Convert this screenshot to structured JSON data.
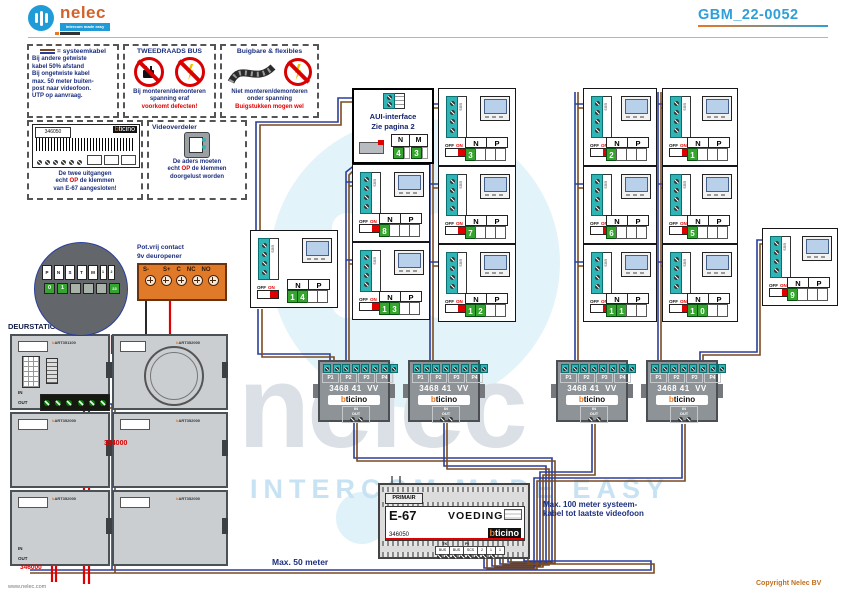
{
  "header": {
    "logo_text": "nelec",
    "logo_tagline": "intercom made easy",
    "doc_code": "GBM_22-0052"
  },
  "brand": {
    "b": "b",
    "rest": "ticino"
  },
  "legend": {
    "syskabel": {
      "title": "= systeemkabel",
      "lines": [
        "Bij andere getwiste",
        "kabel 50% afstand",
        "Bij ongetwiste kabel",
        "max. 50 meter buiten-",
        "post naar videofoon.",
        "UTP op aanvraag."
      ]
    },
    "tweedraads": {
      "title": "TWEEDRAADS BUS",
      "line1": "Bij monteren/demonteren",
      "line2": "spanning eraf",
      "line3": "voorkomt defecten!"
    },
    "flex": {
      "title": "Buigbare & flexibles",
      "line1": "Niet monteren/demonteren",
      "line2": "onder spanning",
      "line3": "Buigstukken mogen wel"
    },
    "videonode": {
      "article": "346050",
      "line1": "De twee uitgangen",
      "line2a": "echt ",
      "line2b": "OP",
      "line2c": " de klemmen",
      "line3": "van E-67 aangesloten!"
    },
    "verdeler": {
      "title": "Videoverdeler",
      "line1": "De aders moeten",
      "line2a": "echt ",
      "line2b": "OP",
      "line2c": " de klemmen",
      "line3": "doorgelust worden"
    }
  },
  "aui": {
    "line1": "AUI-interface",
    "line2": "Zie pagina 2",
    "col_n": "N",
    "col_m": "M",
    "val_n": "4",
    "val_m": "3"
  },
  "videophone": {
    "n_label": "N",
    "p_label": "P",
    "off_label": "OFF",
    "on_label": "ON",
    "bus_label": "BUS"
  },
  "units": [
    {
      "d1": "1",
      "d2": "4"
    },
    {
      "d1": "8",
      "d2": ""
    },
    {
      "d1": "1",
      "d2": "3"
    },
    {
      "d1": "3",
      "d2": ""
    },
    {
      "d1": "7",
      "d2": ""
    },
    {
      "d1": "1",
      "d2": "2"
    },
    {
      "d1": "2",
      "d2": ""
    },
    {
      "d1": "6",
      "d2": ""
    },
    {
      "d1": "1",
      "d2": "1"
    },
    {
      "d1": "1",
      "d2": ""
    },
    {
      "d1": "5",
      "d2": ""
    },
    {
      "d1": "1",
      "d2": "0"
    },
    {
      "d1": "9",
      "d2": ""
    }
  ],
  "distributor": {
    "model": "3468 41",
    "model_suffix": "VV",
    "terminals": [
      "P1",
      "P2",
      "P3",
      "P4"
    ],
    "in_label": "IN",
    "out_label": "OUT"
  },
  "psu": {
    "rail_label": "PRIMAIR",
    "model": "E-67",
    "name": "VOEDING",
    "article": "346050",
    "tk": "TK",
    "pi": "PI",
    "cells": [
      "BUS",
      "BUS",
      "SCS",
      "2",
      "1",
      "1"
    ]
  },
  "door": {
    "title": "DEURSTATION S-131V",
    "pot_line1": "Pot.vrij contact",
    "pot_line2": "9v deuropener",
    "contact_terms": [
      "S-",
      "S+",
      "C",
      "NC",
      "NO"
    ],
    "art_module1": "ART351100",
    "art_module2": "ART352000",
    "label_354": "354000",
    "label_346": "346000",
    "dial_letters": [
      "P",
      "N",
      "S",
      "T",
      "M",
      "1",
      "2"
    ],
    "dial_values": [
      "0",
      "1",
      "",
      "",
      "",
      "23"
    ]
  },
  "notes": {
    "max100_line1": "Max. 100 meter systeem-",
    "max100_line2": "kabel tot laatste videofoon",
    "max50": "Max. 50 meter"
  },
  "watermark": {
    "word": "nelec",
    "tagline": "INTERCOM MADE EASY"
  },
  "footer": {
    "site": "www.nelec.com",
    "copyright": "Copyright Nelec BV"
  },
  "colors": {
    "accent_blue": "#2f9fd8",
    "note_blue": "#1c2f7e",
    "alert_red": "#e00000",
    "brand_orange": "#e87722",
    "teal_terminal": "#2fb5b5",
    "green_cell": "#35a52f",
    "wire_blue": "#2a3f9d",
    "wire_brown": "#7c4a1d"
  }
}
